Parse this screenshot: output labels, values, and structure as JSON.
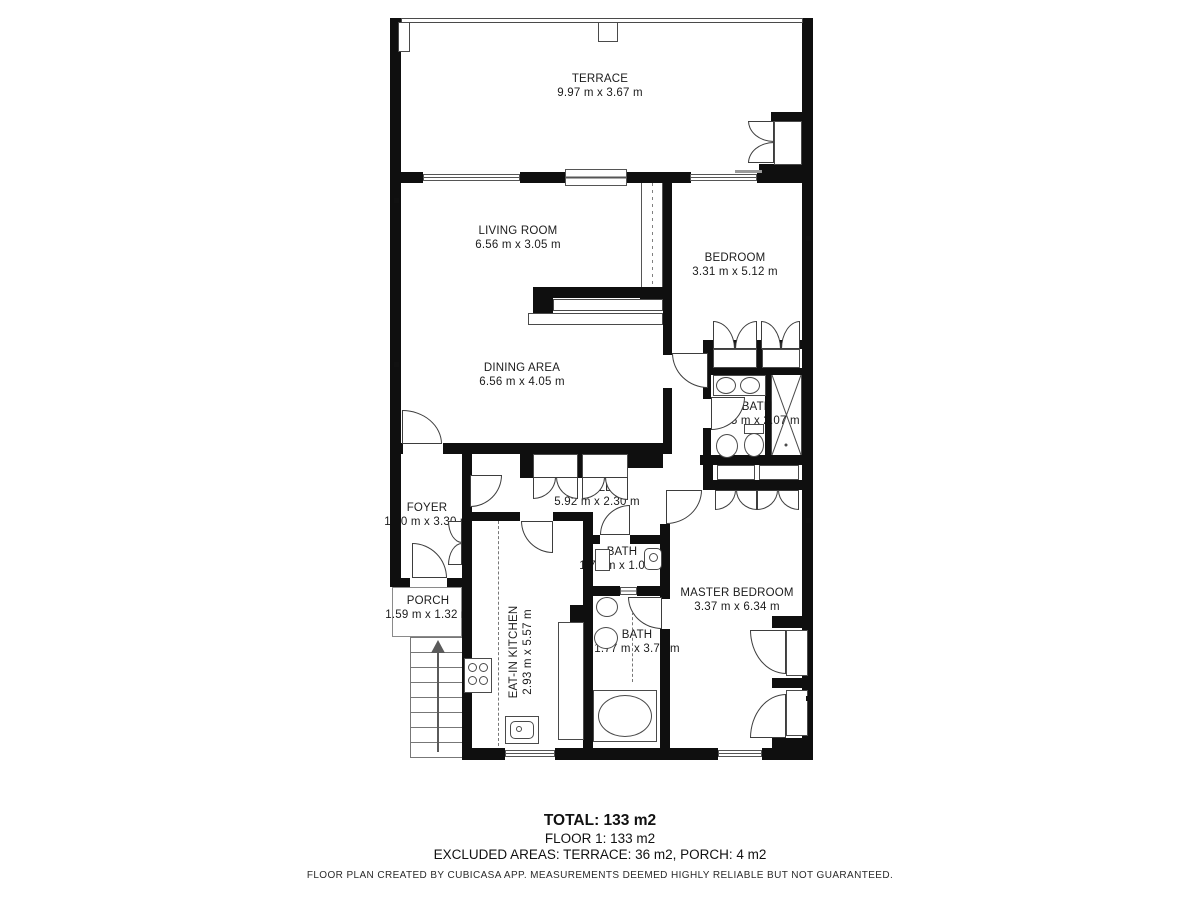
{
  "plan": {
    "rooms": [
      {
        "name": "TERRACE",
        "dims": "9.97 m x 3.67 m"
      },
      {
        "name": "LIVING ROOM",
        "dims": "6.56 m x 3.05 m"
      },
      {
        "name": "BEDROOM",
        "dims": "3.31 m x 5.12 m"
      },
      {
        "name": "DINING AREA",
        "dims": "6.56 m x 4.05 m"
      },
      {
        "name": "BATH",
        "dims": "2.15 m x 2.07 m"
      },
      {
        "name": "HALL",
        "dims": "5.92 m x 2.30 m"
      },
      {
        "name": "FOYER",
        "dims": "1.60 m x 3.30 m"
      },
      {
        "name": "BATH",
        "dims": "1.77 m x 1.07 m"
      },
      {
        "name": "PORCH",
        "dims": "1.59 m x 1.32 m"
      },
      {
        "name": "MASTER BEDROOM",
        "dims": "3.37 m x 6.34 m"
      },
      {
        "name": "EAT-IN KITCHEN",
        "dims": "2.93 m x 5.57 m"
      },
      {
        "name": "BATH",
        "dims": "1.77 m x 3.77 m"
      }
    ]
  },
  "summary": {
    "total": "TOTAL: 133 m2",
    "floor": "FLOOR 1: 133 m2",
    "excluded": "EXCLUDED AREAS: TERRACE: 36 m2, PORCH: 4 m2"
  },
  "disclaimer": "FLOOR PLAN CREATED BY CUBICASA APP. MEASUREMENTS DEEMED HIGHLY RELIABLE BUT NOT GUARANTEED."
}
